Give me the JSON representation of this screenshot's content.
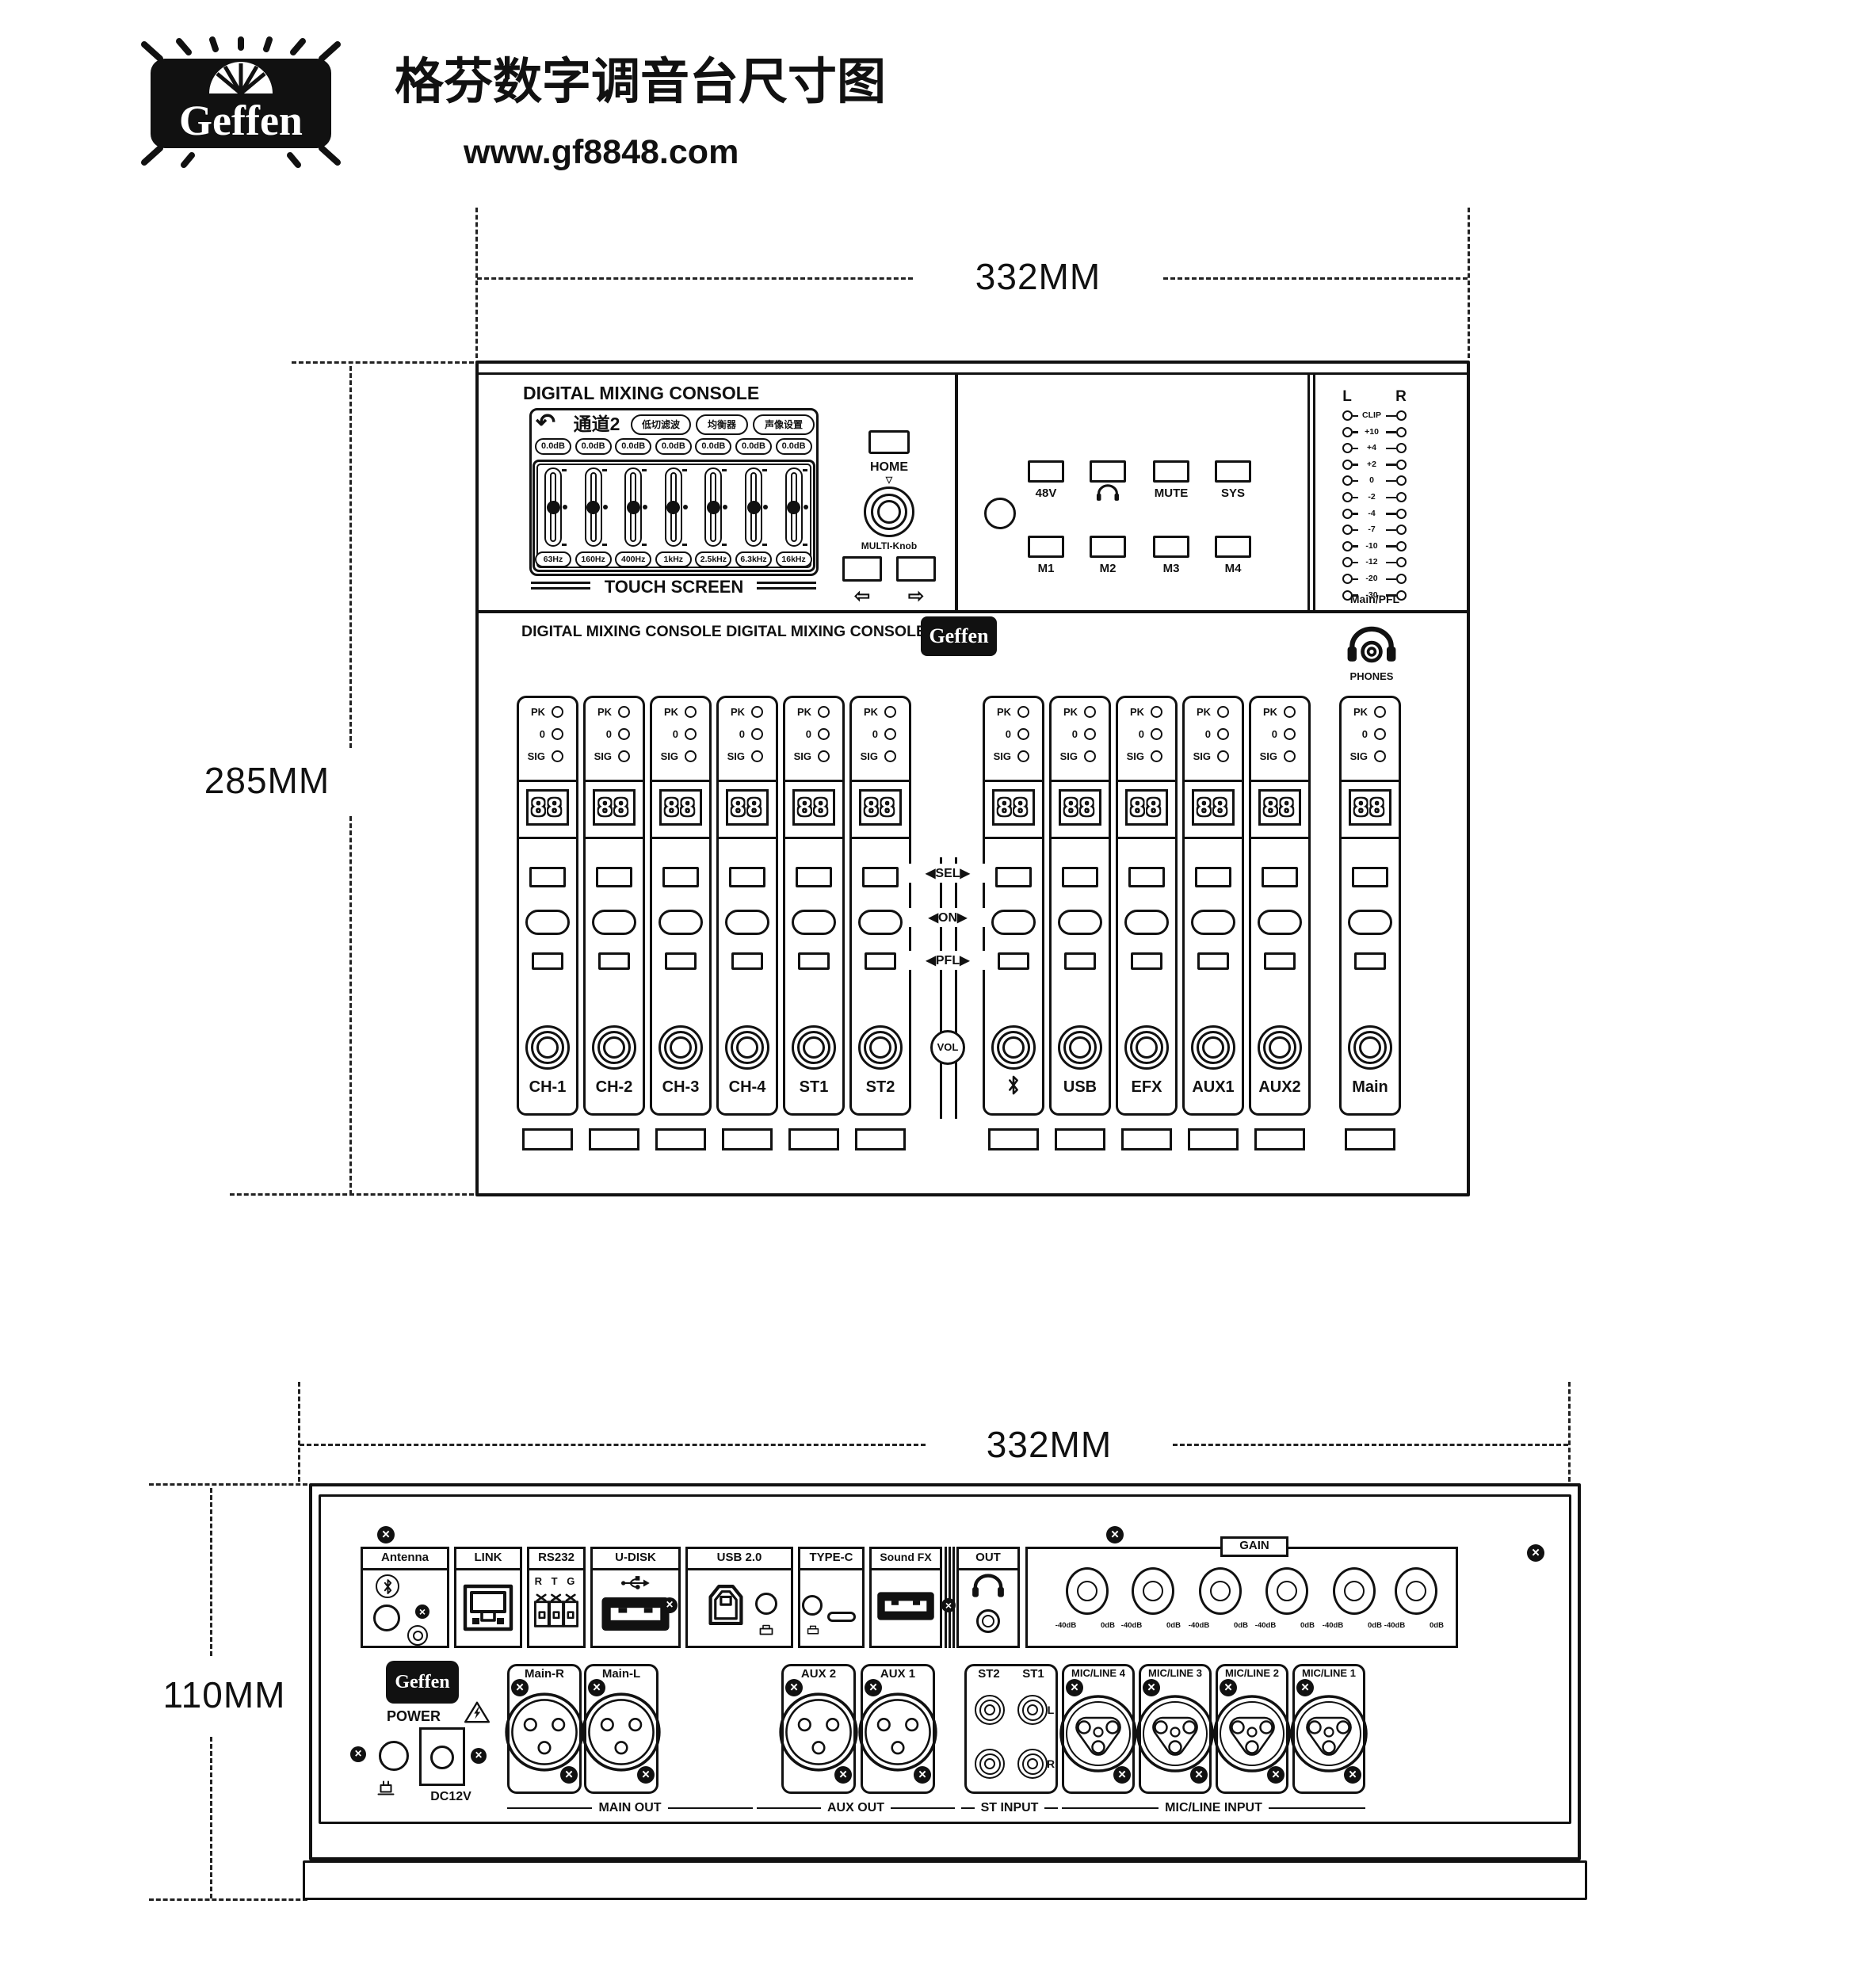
{
  "header": {
    "logo_text": "Geffen",
    "title": "格芬数字调音台尺寸图",
    "website": "www.gf8848.com"
  },
  "dimensions": {
    "top_width": "332MM",
    "top_height": "285MM",
    "rear_width": "332MM",
    "rear_height": "110MM"
  },
  "top_panel": {
    "title": "DIGITAL MIXING CONSOLE",
    "touchscreen": {
      "back_icon": "↶",
      "screen_title": "通道2",
      "tabs": [
        "低切滤波",
        "均衡器",
        "声像设置"
      ],
      "band_gain": "0.0dB",
      "band_freqs": [
        "63Hz",
        "160Hz",
        "400Hz",
        "1kHz",
        "2.5kHz",
        "6.3kHz",
        "16kHz"
      ],
      "caption": "TOUCH SCREEN"
    },
    "home_label": "HOME",
    "knob_pointer": "▽",
    "multi_knob_label": "MULTI-Knob",
    "nav_left": "⇦",
    "nav_right": "⇨",
    "function_buttons_top": [
      {
        "label": "48V"
      },
      {
        "icon": "headphone-icon"
      },
      {
        "label": "MUTE"
      },
      {
        "label": "SYS"
      }
    ],
    "function_buttons_bottom": [
      {
        "label": "M1"
      },
      {
        "label": "M2"
      },
      {
        "label": "M3"
      },
      {
        "label": "M4"
      }
    ],
    "meter": {
      "left": "L",
      "right": "R",
      "scale": [
        "CLIP",
        "+10",
        "+4",
        "+2",
        "0",
        "-2",
        "-4",
        "-7",
        "-10",
        "-12",
        "-20",
        "-30"
      ],
      "caption": "Main/PFL"
    }
  },
  "main_panel": {
    "banner": "DIGITAL MIXING CONSOLE DIGITAL MIXING CONSOLE",
    "logo_text": "Geffen",
    "phones_label": "PHONES",
    "led_labels": [
      "PK",
      "0",
      "SIG"
    ],
    "display_text": "88",
    "divider": {
      "sel": "SEL",
      "on": "ON",
      "pfl": "PFL",
      "vol": "VOL",
      "arrow_left": "◀",
      "arrow_right": "▶"
    },
    "channels": [
      {
        "label": "CH-1"
      },
      {
        "label": "CH-2"
      },
      {
        "label": "CH-3"
      },
      {
        "label": "CH-4"
      },
      {
        "label": "ST1"
      },
      {
        "label": "ST2"
      },
      {
        "icon": "bluetooth-icon"
      },
      {
        "label": "USB"
      },
      {
        "label": "EFX"
      },
      {
        "label": "AUX1"
      },
      {
        "label": "AUX2"
      },
      {
        "label": "Main"
      }
    ]
  },
  "rear_panel": {
    "ports": {
      "antenna": "Antenna",
      "link": "LINK",
      "rs232": "RS232",
      "rs232_pins": "R T G",
      "udisk": "U-DISK",
      "usb20": "USB 2.0",
      "typec": "TYPE-C",
      "soundfx": "Sound FX",
      "out": "OUT"
    },
    "gain": {
      "label": "GAIN",
      "knob_min": "-40dB",
      "knob_max": "0dB"
    },
    "power": {
      "label": "POWER",
      "dc_label": "DC12V"
    },
    "xlr_outputs": [
      "Main-R",
      "Main-L",
      "AUX 2",
      "AUX 1"
    ],
    "st_inputs": {
      "columns": [
        "ST2",
        "ST1"
      ],
      "rows": [
        "L",
        "R"
      ]
    },
    "mic_line_inputs": [
      "MIC/LINE 4",
      "MIC/LINE 3",
      "MIC/LINE 2",
      "MIC/LINE 1"
    ],
    "group_labels": [
      "MAIN OUT",
      "AUX OUT",
      "ST INPUT",
      "MIC/LINE INPUT"
    ]
  }
}
